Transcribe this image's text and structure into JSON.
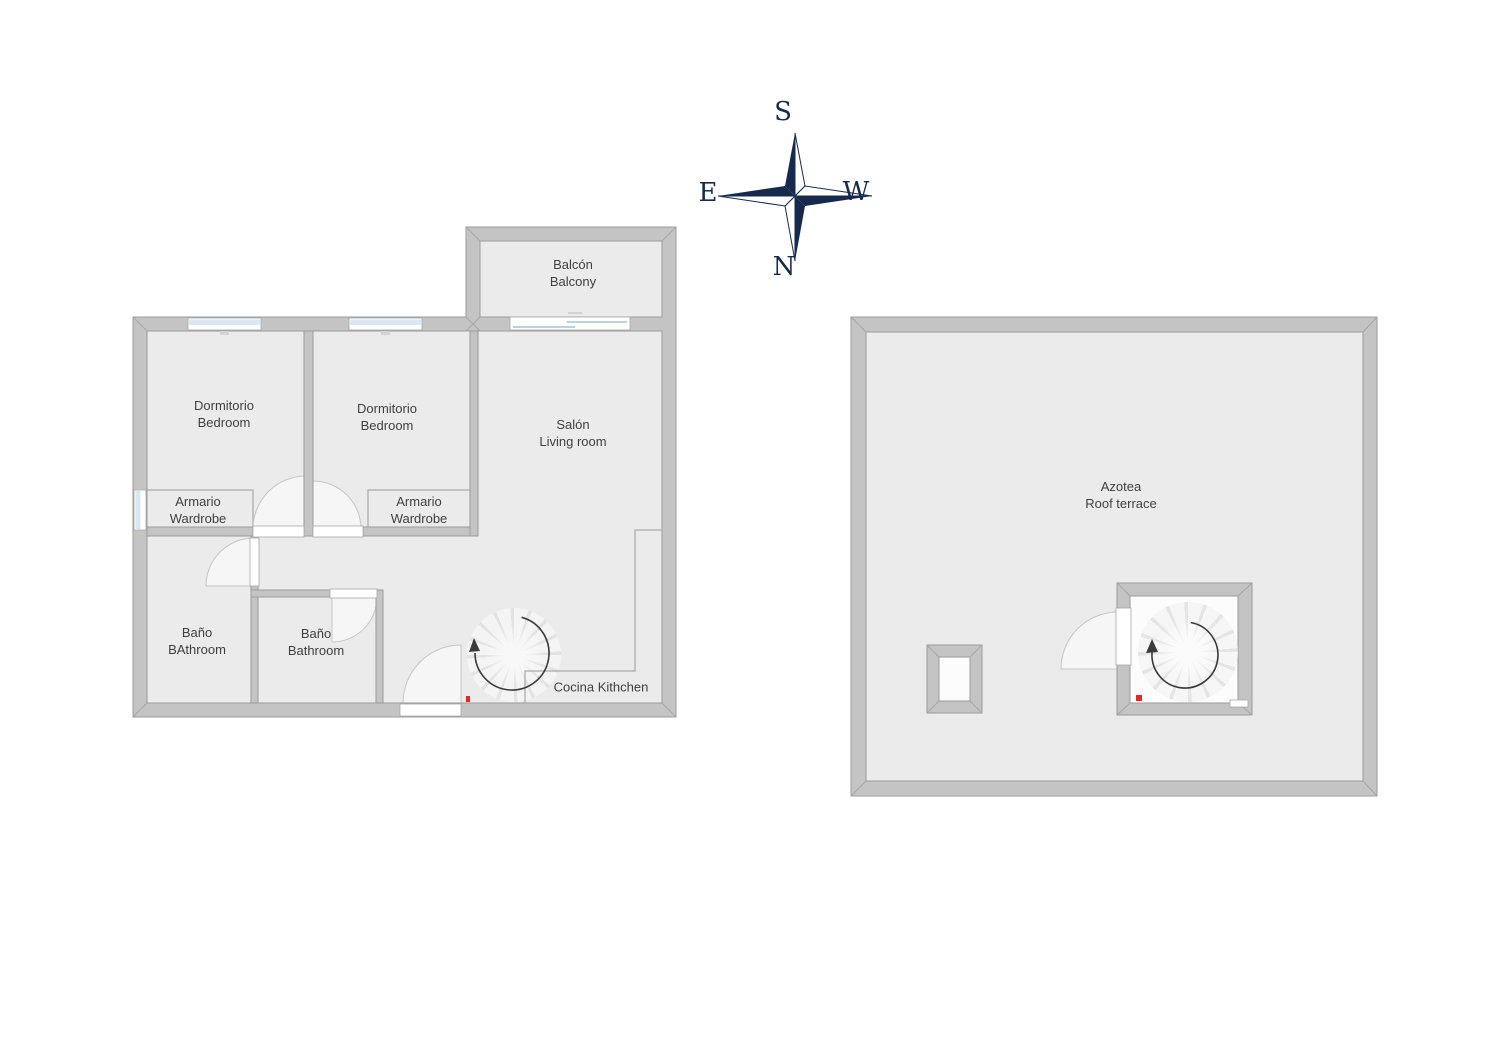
{
  "compass": {
    "top": "S",
    "bottom": "N",
    "left": "E",
    "right": "W"
  },
  "floor1": {
    "bedroom1": {
      "line1": "Dormitorio",
      "line2": "Bedroom"
    },
    "bedroom2": {
      "line1": "Dormitorio",
      "line2": "Bedroom"
    },
    "living": {
      "line1": "Salón",
      "line2": "Living room"
    },
    "balcony": {
      "line1": "Balcón",
      "line2": "Balcony"
    },
    "wardrobe1": {
      "line1": "Armario",
      "line2": "Wardrobe"
    },
    "wardrobe2": {
      "line1": "Armario",
      "line2": "Wardrobe"
    },
    "bath1": {
      "line1": "Baño",
      "line2": "BAthroom"
    },
    "bath2": {
      "line1": "Baño",
      "line2": "Bathroom"
    },
    "kitchen": {
      "line1": "Cocina Kithchen"
    }
  },
  "floor2": {
    "roof": {
      "line1": "Azotea",
      "line2": "Roof terrace"
    }
  },
  "colors": {
    "wall_fill": "#c4c4c4",
    "wall_edge": "#9b9b9b",
    "floor_fill": "#ebebeb",
    "compass_navy": "#172a4d",
    "window_blue": "#d9e8f1",
    "marker_red": "#e82525",
    "label_text": "#3f3f3f"
  }
}
